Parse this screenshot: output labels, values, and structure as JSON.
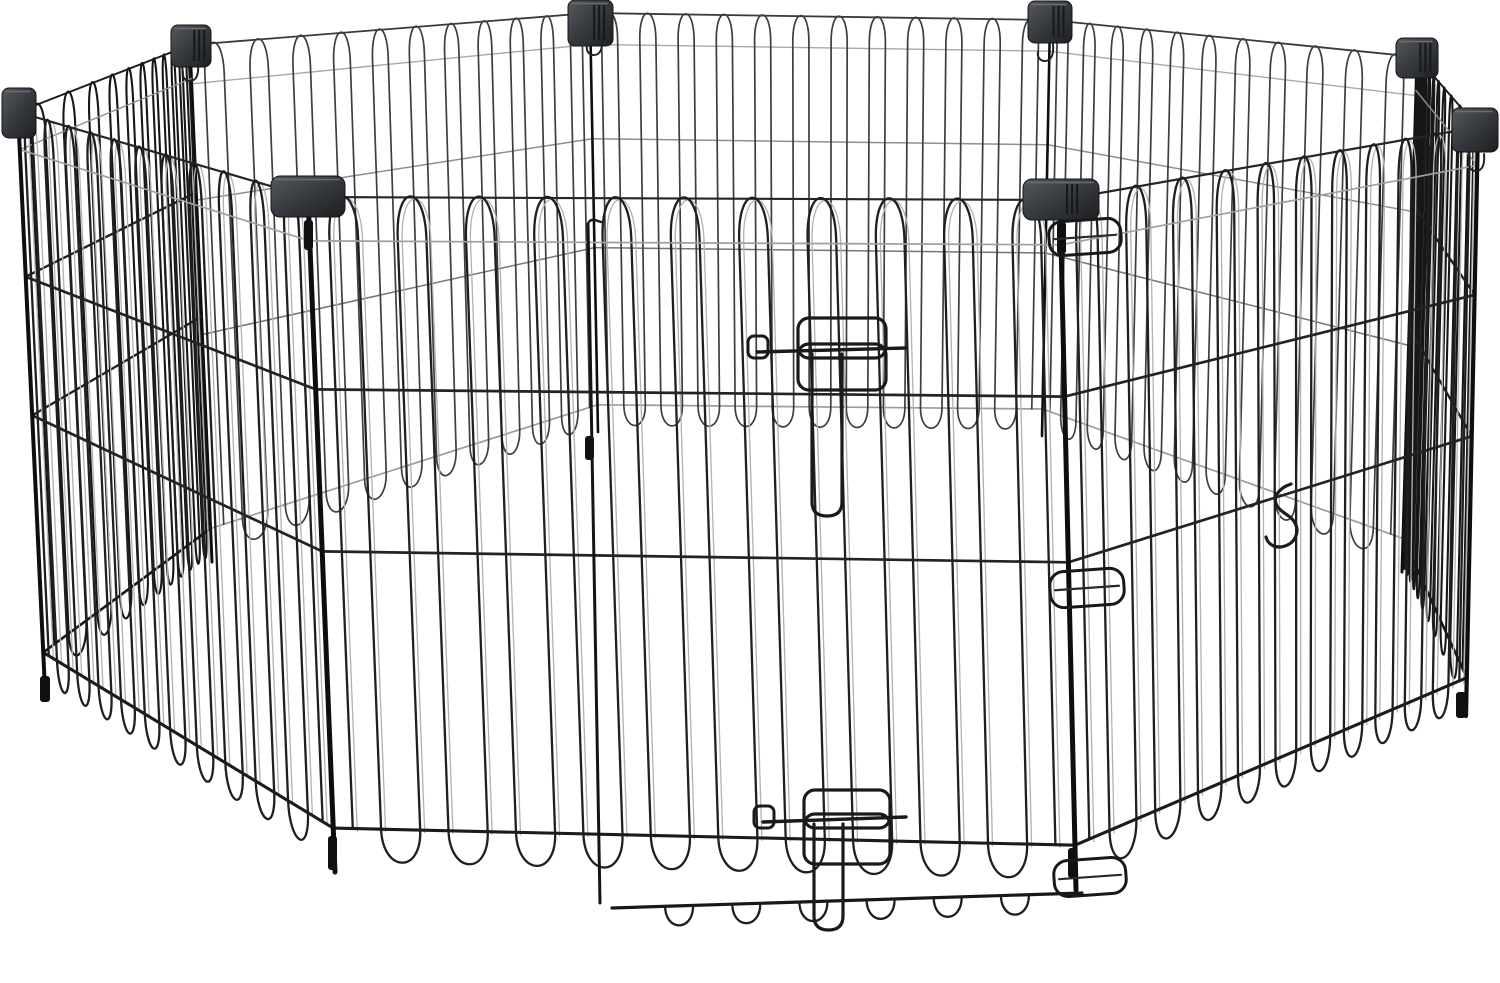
{
  "image": {
    "subject": "Black metal wire foldable pet exercise playpen with eight panels arranged in an octagon and a latched walk-through door",
    "width": 1500,
    "height": 983,
    "background": "#ffffff"
  },
  "palette": {
    "wire_dark": "#1f1f1f",
    "wire_mid": "#3e3e3e",
    "wire_light": "#a8a8a8",
    "highlight": "#b2b2b2",
    "connector_light": "#55595e",
    "connector_dark": "#1e2023",
    "rod": "#0e0e0e"
  },
  "scene": {
    "styles": {
      "outside": {
        "wire": "#1f1f1f",
        "wireW": 2.3,
        "highlight": "#b2b2b2",
        "rails": [
          [
            0.065,
            "#9f9f9f",
            1.7
          ],
          [
            0.285,
            "#232323",
            2.7
          ],
          [
            0.525,
            "#232323",
            2.7
          ],
          [
            0.935,
            "#1b1b1b",
            3.1
          ]
        ],
        "top": [
          "#262626",
          2.2
        ],
        "railsOver": true
      },
      "inside": {
        "wire": "#3e3e3e",
        "wireW": 1.7,
        "rails": [
          [
            0.075,
            "#a8a8a8",
            1.4
          ],
          [
            0.3,
            "#8f8f8f",
            1.5
          ],
          [
            0.56,
            "#757575",
            1.5
          ],
          [
            0.935,
            "#9c9c9c",
            1.7
          ]
        ],
        "top": [
          "#3a3a3a",
          1.8
        ],
        "railsOver": false
      },
      "edge": {
        "wire": "#171717",
        "wireW": 2.1,
        "rails": [
          [
            0.065,
            "#8f8f8f",
            1.4
          ],
          [
            0.285,
            "#1f1f1f",
            2.3
          ],
          [
            0.525,
            "#1f1f1f",
            2.3
          ],
          [
            0.935,
            "#181818",
            2.6
          ]
        ],
        "top": [
          "#1d1d1d",
          2.0
        ],
        "railsOver": true
      }
    },
    "panels": [
      {
        "name": "back-left",
        "style": "inside",
        "loops": 11,
        "persp": 1.3,
        "lt": [
          190,
          45
        ],
        "lb": [
          212,
          562
        ],
        "rt": [
          590,
          13
        ],
        "rb": [
          598,
          432
        ]
      },
      {
        "name": "back-center",
        "style": "inside",
        "loops": 12,
        "persp": 1.0,
        "lt": [
          590,
          13
        ],
        "lb": [
          598,
          432
        ],
        "rt": [
          1050,
          20
        ],
        "rb": [
          1042,
          436
        ]
      },
      {
        "name": "back-right",
        "style": "inside",
        "loops": 11,
        "persp": 0.77,
        "lt": [
          1050,
          20
        ],
        "lb": [
          1042,
          436
        ],
        "rt": [
          1417,
          57
        ],
        "rb": [
          1402,
          572
        ]
      },
      {
        "name": "left-side",
        "style": "edge",
        "loops": 11,
        "persp": 2.6,
        "lt": [
          18,
          112
        ],
        "lb": [
          45,
          690
        ],
        "rt": [
          190,
          45
        ],
        "rb": [
          212,
          562
        ]
      },
      {
        "name": "right-side",
        "style": "edge",
        "loops": 11,
        "persp": 0.38,
        "lt": [
          1417,
          57
        ],
        "lb": [
          1402,
          572
        ],
        "rt": [
          1478,
          127
        ],
        "rb": [
          1466,
          716
        ]
      },
      {
        "name": "front-left",
        "style": "outside",
        "loops": 11,
        "persp": 0.72,
        "lt": [
          18,
          112
        ],
        "lb": [
          45,
          690
        ],
        "rt": [
          308,
          197
        ],
        "rb": [
          335,
          872
        ]
      },
      {
        "name": "front-right",
        "style": "outside",
        "loops": 11,
        "persp": 1.4,
        "lt": [
          1060,
          200
        ],
        "lb": [
          1076,
          890
        ],
        "rt": [
          1478,
          127
        ],
        "rb": [
          1466,
          716
        ]
      },
      {
        "name": "front-door",
        "style": "outside",
        "loops": 11,
        "persp": 1.0,
        "lt": [
          308,
          197
        ],
        "lb": [
          335,
          872
        ],
        "rt": [
          1060,
          200
        ],
        "rb": [
          1076,
          890
        ]
      }
    ],
    "rods": [
      {
        "from": [
          590,
          13
        ],
        "to": [
          598,
          432
        ],
        "w": 2.6,
        "layer": "back"
      },
      {
        "from": [
          1050,
          20
        ],
        "to": [
          1042,
          436
        ],
        "w": 2.6,
        "layer": "back"
      },
      {
        "from": [
          190,
          45
        ],
        "to": [
          212,
          562
        ],
        "w": 3.0,
        "layer": "back"
      },
      {
        "from": [
          1417,
          57
        ],
        "to": [
          1402,
          572
        ],
        "w": 3.0,
        "layer": "back"
      },
      {
        "from": [
          18,
          112
        ],
        "to": [
          45,
          690
        ],
        "w": 4.0,
        "layer": "front"
      },
      {
        "from": [
          1478,
          127
        ],
        "to": [
          1466,
          716
        ],
        "w": 4.2,
        "layer": "front"
      },
      {
        "from": [
          308,
          197
        ],
        "to": [
          335,
          872
        ],
        "w": 5.0,
        "layer": "front"
      },
      {
        "from": [
          1060,
          200
        ],
        "to": [
          1076,
          890
        ],
        "w": 5.0,
        "layer": "front"
      }
    ],
    "connectors": [
      {
        "name": "corner-front-left",
        "x": 271,
        "y": 176,
        "w": 74,
        "h": 41,
        "rx": 9,
        "ribs": false
      },
      {
        "name": "corner-front-right",
        "x": 1023,
        "y": 179,
        "w": 76,
        "h": 41,
        "rx": 9,
        "ribs": true
      },
      {
        "name": "corner-left",
        "x": 2,
        "y": 88,
        "w": 34,
        "h": 50,
        "rx": 7,
        "ribs": false
      },
      {
        "name": "corner-back-left",
        "x": 171,
        "y": 25,
        "w": 40,
        "h": 42,
        "rx": 7,
        "ribs": true
      },
      {
        "name": "corner-back-mid-left",
        "x": 568,
        "y": 0,
        "w": 45,
        "h": 46,
        "rx": 7,
        "ribs": true
      },
      {
        "name": "corner-back-mid-right",
        "x": 1028,
        "y": 1,
        "w": 44,
        "h": 42,
        "rx": 7,
        "ribs": true
      },
      {
        "name": "corner-back-right",
        "x": 1396,
        "y": 38,
        "w": 42,
        "h": 40,
        "rx": 7,
        "ribs": true
      },
      {
        "name": "corner-right",
        "x": 1452,
        "y": 108,
        "w": 46,
        "h": 44,
        "rx": 7,
        "ribs": false
      }
    ],
    "door": {
      "seam": {
        "x1": 588,
        "y1": 224,
        "x2": 600,
        "y2": 903
      },
      "bottom_rail": {
        "x1": 612,
        "y1": 908,
        "x2": 1082,
        "y2": 893,
        "feet": 7,
        "dip": 26
      },
      "hinges": [
        {
          "cx": 1085,
          "cy": 237,
          "w": 72,
          "h": 34
        },
        {
          "cx": 1087,
          "cy": 588,
          "w": 74,
          "h": 36
        },
        {
          "cx": 1090,
          "cy": 877,
          "w": 72,
          "h": 36
        }
      ],
      "latches": [
        {
          "g1": [
            798,
            318,
            88,
            40
          ],
          "g2": [
            798,
            344,
            88,
            46
          ],
          "bar": [
            757,
            352,
            906,
            348
          ],
          "handle": [
            748,
            336,
            20,
            22
          ],
          "u": [
            812,
            842,
            354,
            516
          ]
        },
        {
          "g1": [
            804,
            790,
            86,
            38
          ],
          "g2": [
            804,
            814,
            86,
            50
          ],
          "bar": [
            763,
            822,
            906,
            817
          ],
          "handle": [
            754,
            806,
            20,
            22
          ],
          "u": [
            814,
            843,
            824,
            930
          ]
        }
      ],
      "spring_hook": {
        "x": 1285,
        "y": 512
      }
    },
    "sleeves": [
      [
        304,
        220,
        9,
        30
      ],
      [
        1057,
        222,
        9,
        32
      ],
      [
        40,
        676,
        10,
        26
      ],
      [
        328,
        836,
        9,
        34
      ],
      [
        1068,
        848,
        9,
        30
      ],
      [
        1456,
        692,
        10,
        26
      ],
      [
        585,
        436,
        9,
        24
      ]
    ],
    "hooks": [
      {
        "x": 602,
        "y": 38
      },
      {
        "x": 198,
        "y": 64
      },
      {
        "x": 1484,
        "y": 154
      },
      {
        "x": 1053,
        "y": 44
      }
    ]
  }
}
